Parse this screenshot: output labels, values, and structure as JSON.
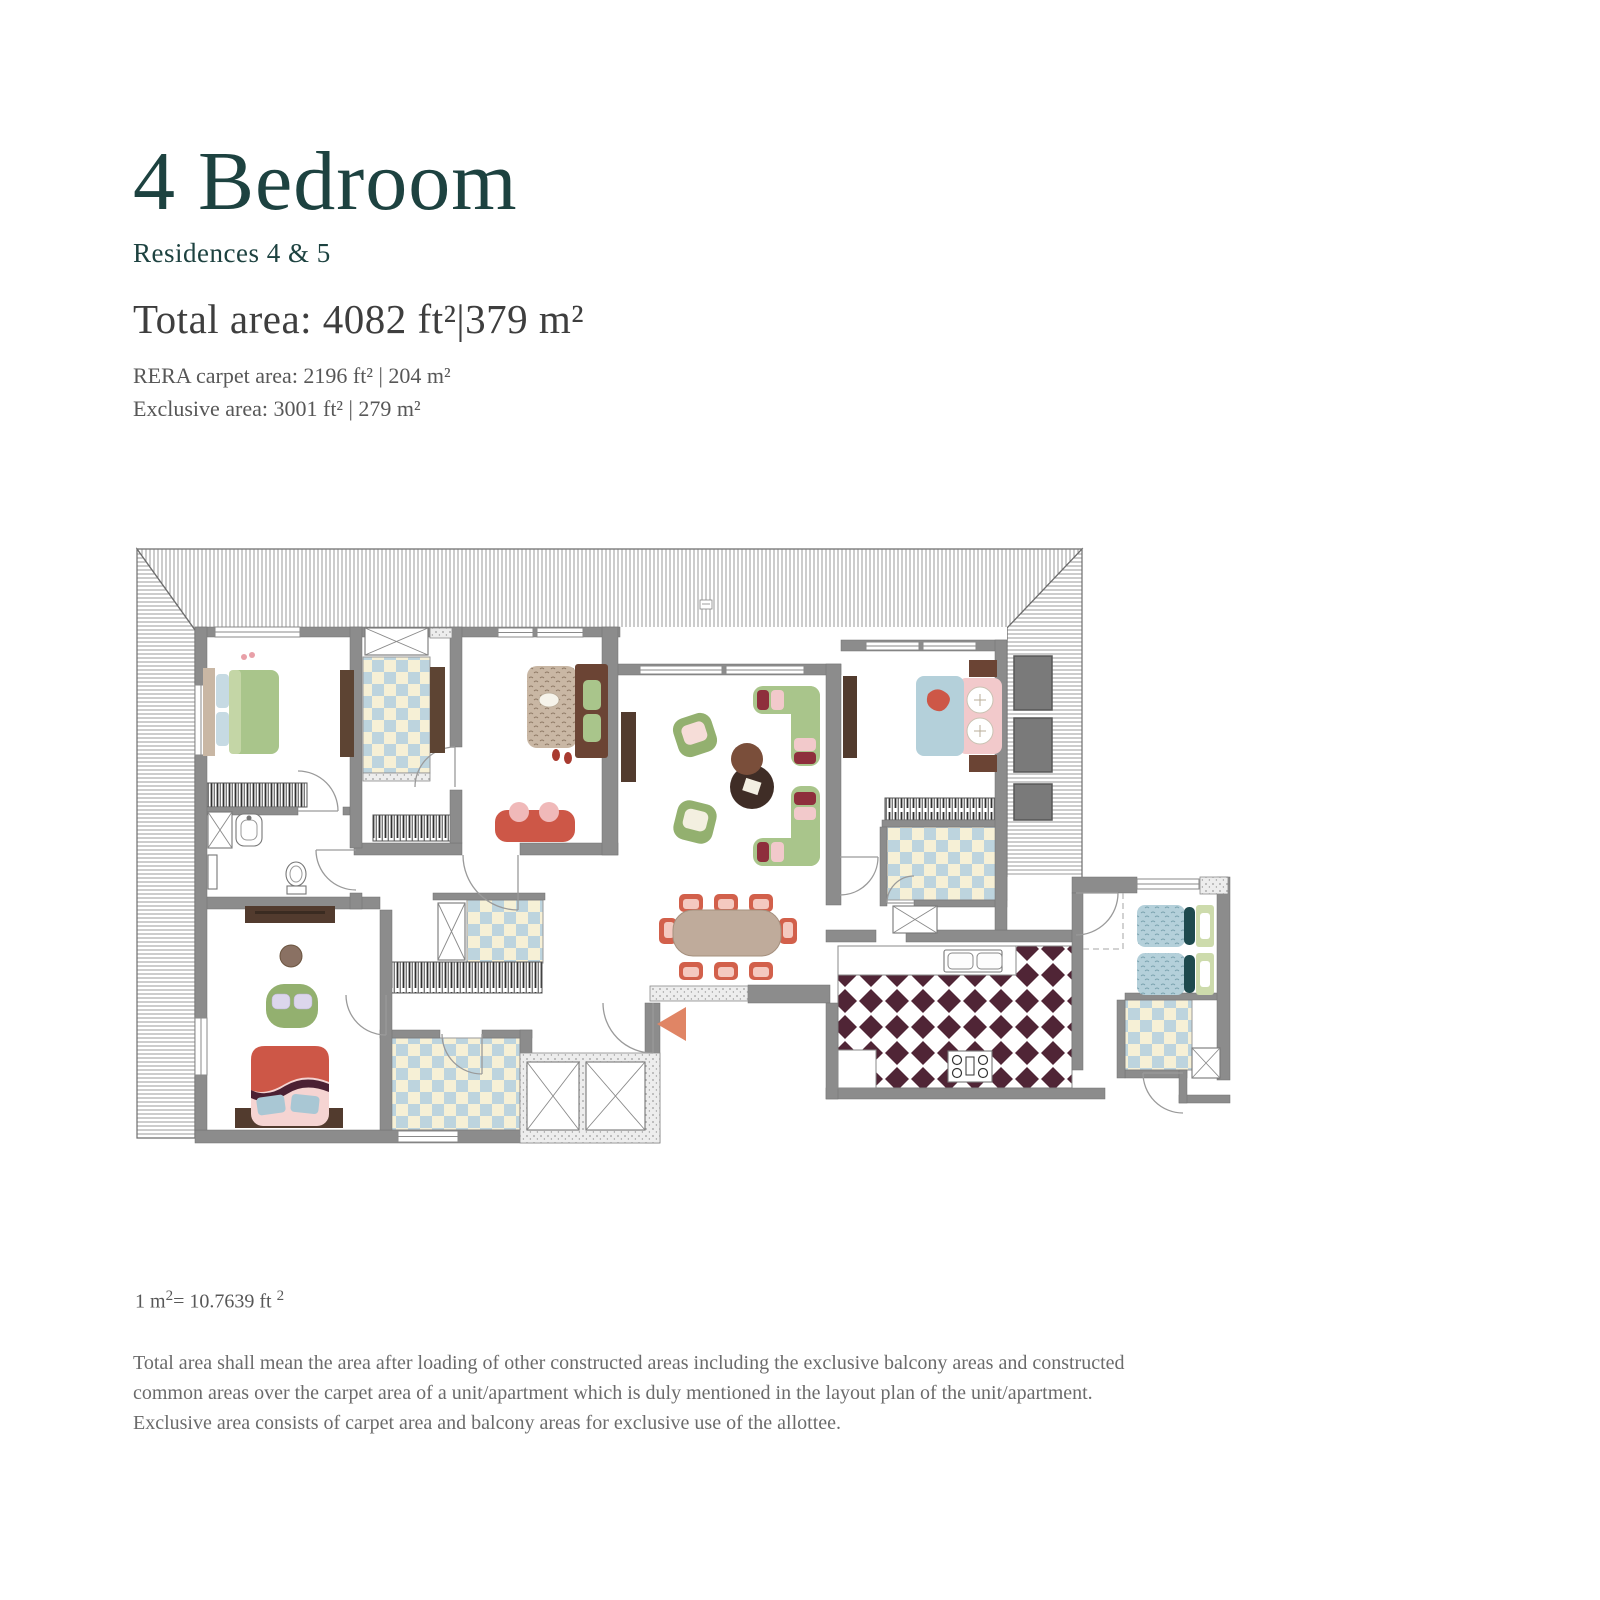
{
  "header": {
    "title": "4 Bedroom",
    "subtitle": "Residences 4 & 5",
    "total_area": "Total area: 4082 ft²|379 m²",
    "rera_area": "RERA carpet area: 2196 ft² | 204 m²",
    "exclusive_area": "Exclusive area: 3001 ft² | 279 m²"
  },
  "footnotes": {
    "conversion": {
      "base1": "1 m",
      "sup1": "2",
      "base2": "= 10.7639 ft ",
      "sup2": "2"
    },
    "disclaimer": "Total area shall mean the area after loading of other constructed areas including the exclusive balcony areas and constructed common areas over the carpet area of a unit/apartment which is duly mentioned in the layout plan of the unit/apartment. Exclusive area consists of carpet area and balcony areas for exclusive use of the allottee."
  },
  "palette": {
    "teal": "#1d4240",
    "text_dark": "#3e3e3e",
    "text_mid": "#575757",
    "text_light": "#6b6b6b",
    "wall": "#8c8c8c",
    "wall_dark": "#707070",
    "hatch_line": "#8f8f8f",
    "keys_line": "#2f2f2f",
    "checker_blue": "#bdd4de",
    "checker_cream": "#f6f0d6",
    "kitchen_maroon": "#502536",
    "green": "#a9c58b",
    "green_dark": "#93b06f",
    "green_pale": "#cddbac",
    "pink": "#f2c9cb",
    "red": "#cd5747",
    "chair_red": "#d2604b",
    "dark_red": "#8e2f3c",
    "maroon": "#4b2033",
    "blue": "#b4d0da",
    "teal_dark": "#1e4a4e",
    "tan": "#c9b7a4",
    "brown": "#6b4434",
    "brown_dark": "#523b2e",
    "table_tan": "#bfab9b",
    "planter": "#7a7a7a",
    "arrow": "#e08565",
    "lavender": "#dcd6ec",
    "speck_bg": "#ededed"
  }
}
